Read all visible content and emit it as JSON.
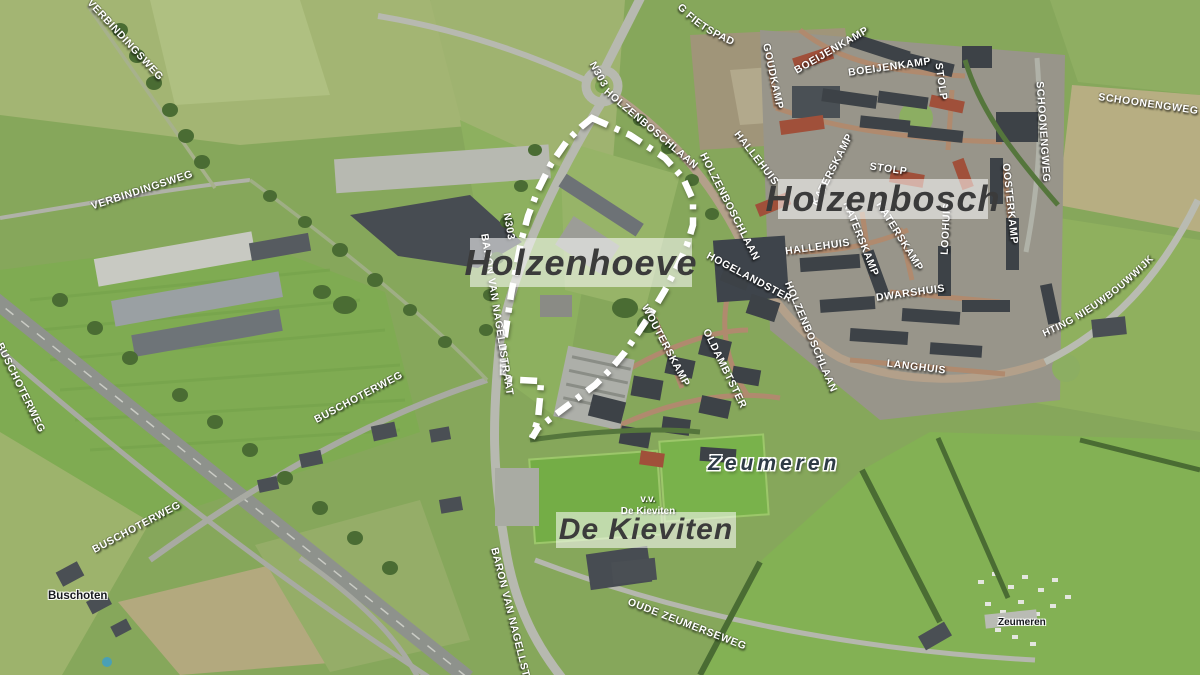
{
  "map": {
    "type": "aerial-satellite-annotated",
    "colors": {
      "boundary": "#ffffff",
      "area_label_bg": "#ffffff",
      "area_label_text": "#3b3b3b",
      "road_label_text": "#ffffff"
    },
    "areas": {
      "holzenbosch": {
        "name": "Holzenbosch"
      },
      "holzenhoeve": {
        "name": "Holzenhoeve"
      },
      "de_kieviten": {
        "name": "De Kieviten"
      },
      "zeumeren": {
        "name": "Zeumeren"
      }
    },
    "places": {
      "buschoten": {
        "name": "Buschoten"
      },
      "zeumeren_camping": {
        "name": "Zeumeren"
      },
      "vv_de_kieviten": {
        "line1": "v.v.",
        "line2": "De Kieviten"
      }
    },
    "road_labels": [
      {
        "name": "VERBINDINGSWEG"
      },
      {
        "name": "VERBINDINGSWEG"
      },
      {
        "name": "BUSCHOTERWEG"
      },
      {
        "name": "BUSCHOTERWEG"
      },
      {
        "name": "BUSCHOTERWEG"
      },
      {
        "name": "TOEKOMSTIG FIETSPAD"
      },
      {
        "name": "N303"
      },
      {
        "name": "N303"
      },
      {
        "name": "BARON VAN NAGELLSTRAAT"
      },
      {
        "name": "BARON VAN NAGELLSTRAAT"
      },
      {
        "name": "HOLZENBOSCHLAAN"
      },
      {
        "name": "HOLZENBOSCHLAAN"
      },
      {
        "name": "HOLZENBOSCHLAAN"
      },
      {
        "name": "GOUDKAMP"
      },
      {
        "name": "BOEIJENKAMP"
      },
      {
        "name": "BOEIJENKAMP"
      },
      {
        "name": "STOLP"
      },
      {
        "name": "STOLP"
      },
      {
        "name": "SCHOONENGWEG"
      },
      {
        "name": "SCHOONENGWEG"
      },
      {
        "name": "OOSTERKAMP"
      },
      {
        "name": "HALLEHUIS"
      },
      {
        "name": "HALLEHUIS"
      },
      {
        "name": "KATERSKAMP"
      },
      {
        "name": "KATERSKAMP"
      },
      {
        "name": "KATERSKAMP"
      },
      {
        "name": "LOOHUIS"
      },
      {
        "name": "DWARSHUIS"
      },
      {
        "name": "LANGHUIS"
      },
      {
        "name": "HOGELANDSTER"
      },
      {
        "name": "OLDAMBTSTER"
      },
      {
        "name": "WOUTERSKAMP"
      },
      {
        "name": "OUDE ZEUMERSEWEG"
      },
      {
        "name": "TOEKOMSTIGE WEG RICHTING NIEUWBOUWWIJK"
      }
    ]
  }
}
